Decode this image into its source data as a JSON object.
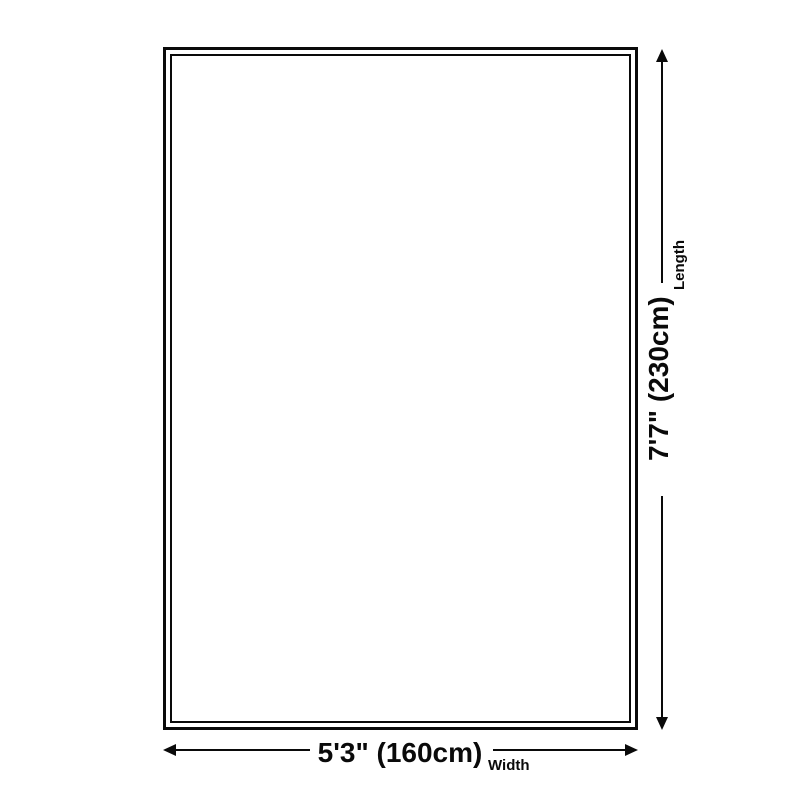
{
  "diagram": {
    "kind": "rug-size-diagram",
    "background_color": "#ffffff",
    "ink_color": "#0a0a0a",
    "shape": "rectangle-double-border"
  },
  "length_dimension": {
    "axis_label": "Length",
    "value": "7'7\" (230cm)",
    "orientation": "vertical",
    "arrow_icons": [
      "arrow-up-icon",
      "arrow-down-icon"
    ]
  },
  "width_dimension": {
    "axis_label": "Width",
    "value": "5'3\" (160cm)",
    "orientation": "horizontal",
    "arrow_icons": [
      "arrow-left-icon",
      "arrow-right-icon"
    ]
  }
}
